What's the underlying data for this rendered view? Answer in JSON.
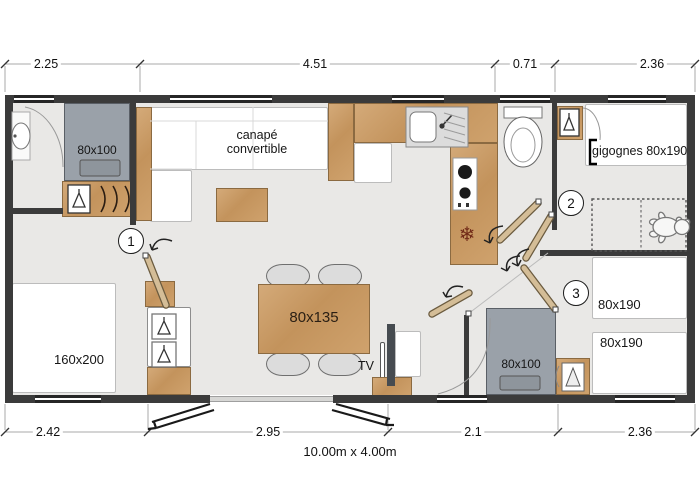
{
  "title": "10.00m x 4.00m",
  "dimensions": {
    "top": [
      "2.25",
      "4.51",
      "0.71",
      "2.36"
    ],
    "bottom": [
      "2.42",
      "2.95",
      "2.1",
      "2.36"
    ]
  },
  "labels": {
    "sofa": "canapé convertible",
    "shower_master": "80x100",
    "shower_second": "80x100",
    "bed_master": "160x200",
    "dining_table": "80x135",
    "tv": "TV",
    "bed_trundle": "gigognes 80x190",
    "bed_single_1": "80x190",
    "bed_single_2": "80x190"
  },
  "room_numbers": [
    "1",
    "2",
    "3"
  ],
  "icons": {
    "fridge_snowflake": "❄"
  },
  "colors": {
    "floor": "#e9e8e6",
    "wall": "#3b3b3b",
    "wood": "#c89e6b",
    "shower": "#9aa1a9",
    "door_leaf": "#d4bd97"
  }
}
